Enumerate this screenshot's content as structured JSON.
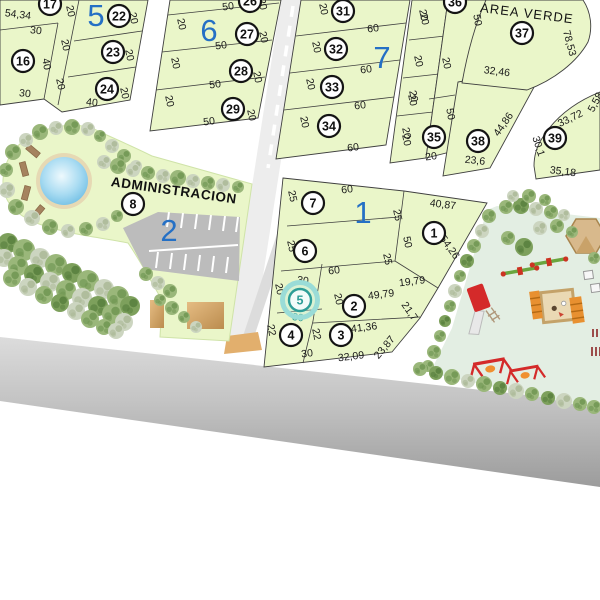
{
  "colors": {
    "lot_fill": "#eaf6c9",
    "parcel_stroke": "#3f3f3f",
    "block_number_blue": "#2570c5",
    "selection_teal": "#2d9d97",
    "street": "#ededed",
    "main_road_top": "#d6d6d6",
    "main_road_bottom": "#9c9c9c",
    "playground_fill": "#e3eee3",
    "parking_fill": "#bcbcbc",
    "crosswalk_tan": "#e2af6d",
    "pool_blue": "#5db5e0"
  },
  "plan": {
    "selected_lot": "5",
    "area_labels": {
      "area_verde": "AREA VERDE",
      "administracion": "ADMINISTRACION"
    },
    "block_numbers": [
      {
        "t": "5",
        "x": 96,
        "y": 15
      },
      {
        "t": "6",
        "x": 209,
        "y": 30
      },
      {
        "t": "7",
        "x": 382,
        "y": 57
      },
      {
        "t": "1",
        "x": 363,
        "y": 212
      },
      {
        "t": "2",
        "x": 169,
        "y": 230
      }
    ],
    "lot_circles": [
      {
        "n": "17",
        "x": 50,
        "y": 4
      },
      {
        "n": "22",
        "x": 119,
        "y": 16
      },
      {
        "n": "16",
        "x": 23,
        "y": 61
      },
      {
        "n": "23",
        "x": 113,
        "y": 52
      },
      {
        "n": "24",
        "x": 107,
        "y": 89
      },
      {
        "n": "26",
        "x": 250,
        "y": 1
      },
      {
        "n": "27",
        "x": 247,
        "y": 34
      },
      {
        "n": "28",
        "x": 241,
        "y": 71
      },
      {
        "n": "29",
        "x": 233,
        "y": 109
      },
      {
        "n": "31",
        "x": 343,
        "y": 11
      },
      {
        "n": "32",
        "x": 336,
        "y": 49
      },
      {
        "n": "33",
        "x": 332,
        "y": 87
      },
      {
        "n": "34",
        "x": 329,
        "y": 126
      },
      {
        "n": "36",
        "x": 455,
        "y": 2
      },
      {
        "n": "35",
        "x": 434,
        "y": 137
      },
      {
        "n": "37",
        "x": 522,
        "y": 33
      },
      {
        "n": "38",
        "x": 478,
        "y": 141
      },
      {
        "n": "39",
        "x": 555,
        "y": 138
      },
      {
        "n": "7",
        "x": 313,
        "y": 203
      },
      {
        "n": "6",
        "x": 305,
        "y": 251
      },
      {
        "n": "5",
        "x": 300,
        "y": 300,
        "sel": true
      },
      {
        "n": "2",
        "x": 354,
        "y": 306
      },
      {
        "n": "4",
        "x": 291,
        "y": 335
      },
      {
        "n": "3",
        "x": 341,
        "y": 335
      },
      {
        "n": "1",
        "x": 434,
        "y": 233
      },
      {
        "n": "8",
        "x": 133,
        "y": 204
      }
    ],
    "dim_labels": [
      {
        "t": "54,34",
        "x": 18,
        "y": 14,
        "r": 7
      },
      {
        "t": "20",
        "x": 71,
        "y": 11,
        "r": 78
      },
      {
        "t": "20",
        "x": 134,
        "y": 18,
        "r": 78
      },
      {
        "t": "30",
        "x": 36,
        "y": 30,
        "r": 6
      },
      {
        "t": "20",
        "x": 66,
        "y": 45,
        "r": 78
      },
      {
        "t": "20",
        "x": 130,
        "y": 55,
        "r": 78
      },
      {
        "t": "40",
        "x": 47,
        "y": 64,
        "r": 80
      },
      {
        "t": "20",
        "x": 61,
        "y": 84,
        "r": 78
      },
      {
        "t": "20",
        "x": 125,
        "y": 93,
        "r": 78
      },
      {
        "t": "30",
        "x": 25,
        "y": 93,
        "r": 6
      },
      {
        "t": "40",
        "x": 92,
        "y": 102,
        "r": 6
      },
      {
        "t": "50",
        "x": 228,
        "y": 6,
        "r": -7
      },
      {
        "t": "20",
        "x": 263,
        "y": 4,
        "r": 78
      },
      {
        "t": "20",
        "x": 182,
        "y": 24,
        "r": 78
      },
      {
        "t": "20",
        "x": 264,
        "y": 37,
        "r": 78
      },
      {
        "t": "50",
        "x": 221,
        "y": 45,
        "r": -7
      },
      {
        "t": "20",
        "x": 176,
        "y": 63,
        "r": 78
      },
      {
        "t": "20",
        "x": 258,
        "y": 77,
        "r": 78
      },
      {
        "t": "50",
        "x": 215,
        "y": 84,
        "r": -7
      },
      {
        "t": "20",
        "x": 170,
        "y": 101,
        "r": 78
      },
      {
        "t": "20",
        "x": 252,
        "y": 115,
        "r": 78
      },
      {
        "t": "50",
        "x": 209,
        "y": 121,
        "r": -7
      },
      {
        "t": "20",
        "x": 324,
        "y": 9,
        "r": 78
      },
      {
        "t": "20",
        "x": 424,
        "y": 15,
        "r": 78
      },
      {
        "t": "60",
        "x": 373,
        "y": 28,
        "r": -7
      },
      {
        "t": "20",
        "x": 317,
        "y": 47,
        "r": 78
      },
      {
        "t": "20",
        "x": 419,
        "y": 61,
        "r": 78
      },
      {
        "t": "60",
        "x": 366,
        "y": 69,
        "r": -7
      },
      {
        "t": "20",
        "x": 311,
        "y": 84,
        "r": 78
      },
      {
        "t": "20",
        "x": 413,
        "y": 100,
        "r": 78
      },
      {
        "t": "60",
        "x": 360,
        "y": 105,
        "r": -7
      },
      {
        "t": "20",
        "x": 305,
        "y": 122,
        "r": 78
      },
      {
        "t": "20",
        "x": 407,
        "y": 140,
        "r": 78
      },
      {
        "t": "60",
        "x": 353,
        "y": 147,
        "r": -7
      },
      {
        "t": "20",
        "x": 425,
        "y": 19,
        "r": 78
      },
      {
        "t": "50",
        "x": 478,
        "y": 20,
        "r": 80
      },
      {
        "t": "20",
        "x": 447,
        "y": 63,
        "r": 78
      },
      {
        "t": "20",
        "x": 414,
        "y": 96,
        "r": 78
      },
      {
        "t": "50",
        "x": 451,
        "y": 114,
        "r": 80
      },
      {
        "t": "20",
        "x": 407,
        "y": 133,
        "r": 78
      },
      {
        "t": "20",
        "x": 431,
        "y": 156,
        "r": -7
      },
      {
        "t": "32,46",
        "x": 497,
        "y": 71,
        "r": 7
      },
      {
        "t": "44,86",
        "x": 503,
        "y": 124,
        "r": -55
      },
      {
        "t": "23,6",
        "x": 475,
        "y": 160,
        "r": 6
      },
      {
        "t": "78,53",
        "x": 570,
        "y": 43,
        "r": 75
      },
      {
        "t": "33,72",
        "x": 570,
        "y": 118,
        "r": -26
      },
      {
        "t": "5,58",
        "x": 595,
        "y": 102,
        "r": -62
      },
      {
        "t": "30,1",
        "x": 539,
        "y": 146,
        "r": 72
      },
      {
        "t": "35,18",
        "x": 563,
        "y": 171,
        "r": 7
      },
      {
        "t": "25",
        "x": 293,
        "y": 196,
        "r": 78
      },
      {
        "t": "60",
        "x": 347,
        "y": 189,
        "r": -7
      },
      {
        "t": "25",
        "x": 398,
        "y": 215,
        "r": 78
      },
      {
        "t": "40,87",
        "x": 443,
        "y": 204,
        "r": 7
      },
      {
        "t": "54,26",
        "x": 450,
        "y": 247,
        "r": 55
      },
      {
        "t": "50",
        "x": 408,
        "y": 242,
        "r": 78
      },
      {
        "t": "25",
        "x": 292,
        "y": 246,
        "r": 78
      },
      {
        "t": "60",
        "x": 334,
        "y": 270,
        "r": -7
      },
      {
        "t": "25",
        "x": 388,
        "y": 259,
        "r": 78
      },
      {
        "t": "19,79",
        "x": 412,
        "y": 281,
        "r": -7
      },
      {
        "t": "30",
        "x": 303,
        "y": 280,
        "r": 7
      },
      {
        "t": "20",
        "x": 280,
        "y": 289,
        "r": 78
      },
      {
        "t": "30",
        "x": 298,
        "y": 317,
        "r": 7,
        "c": "sel"
      },
      {
        "t": "49,79",
        "x": 381,
        "y": 294,
        "r": -7
      },
      {
        "t": "20",
        "x": 339,
        "y": 299,
        "r": 78
      },
      {
        "t": "21,7",
        "x": 410,
        "y": 311,
        "r": 55
      },
      {
        "t": "22",
        "x": 272,
        "y": 330,
        "r": 78
      },
      {
        "t": "22",
        "x": 317,
        "y": 334,
        "r": 78
      },
      {
        "t": "41,36",
        "x": 364,
        "y": 327,
        "r": -7
      },
      {
        "t": "30",
        "x": 307,
        "y": 353,
        "r": -7
      },
      {
        "t": "32,09",
        "x": 351,
        "y": 356,
        "r": -7
      },
      {
        "t": "23,87",
        "x": 384,
        "y": 347,
        "r": -50
      }
    ]
  }
}
